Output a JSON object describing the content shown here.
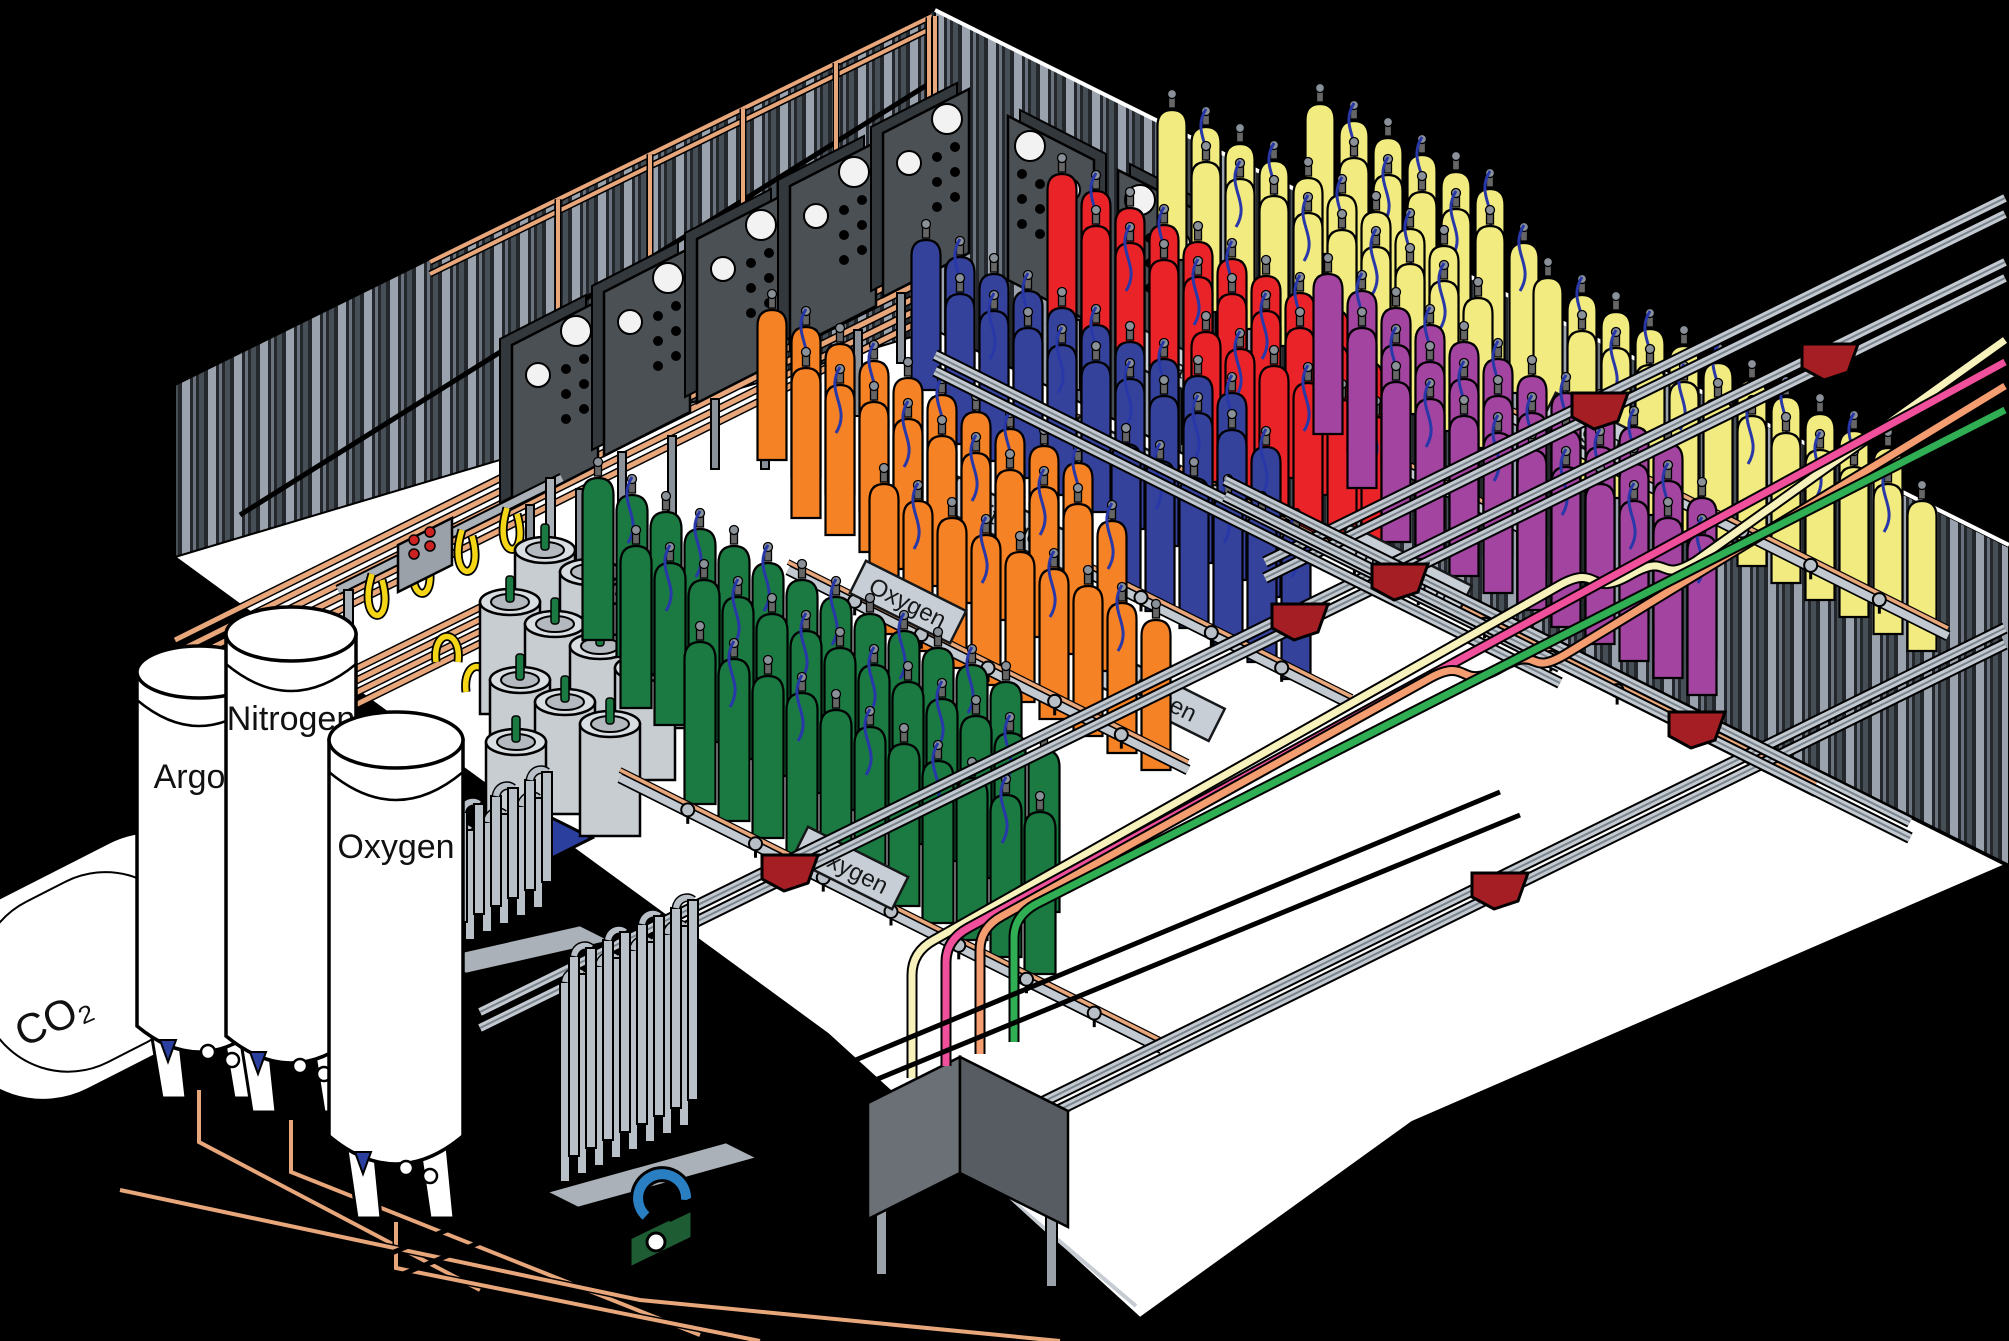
{
  "scene": {
    "subject": "Industrial gas cylinder filling plant (isometric cutaway)",
    "outside_color": "#000000",
    "floor_color": "#ffffff",
    "wall_panel_light": "#9aa3ad",
    "wall_panel_dark": "#24282c",
    "copper_pipe_color": "#e8a67b",
    "rail_color": "#c2c9d1",
    "trolley_color": "#a51e23",
    "sign_plate_color": "#c7ced6",
    "sign_text_color": "#16181a",
    "pigtail_hose_color": "#2838a8",
    "transfer_hose_color": "#f5d616",
    "dewar_color": "#c8cdd2",
    "control_panel_color": "#4b5054",
    "tank_color": "#ffffff"
  },
  "storage_tanks": [
    {
      "id": "co2-tank",
      "label": "CO₂"
    },
    {
      "id": "argon-tank",
      "label": "Argon"
    },
    {
      "id": "nitrogen-tank",
      "label": "Nitrogen"
    },
    {
      "id": "oxygen-tank",
      "label": "Oxygen"
    }
  ],
  "racks": [
    {
      "id": "oxygen-green",
      "label": "Oxygen",
      "cylinder_color": "#1b7a42"
    },
    {
      "id": "oxygen-orange",
      "label": "Oxygen",
      "cylinder_color": "#f58224"
    },
    {
      "id": "nitrogen-blue",
      "label": "Nitrogen",
      "cylinder_color": "#35429b"
    },
    {
      "id": "helium-red",
      "label": "Helium",
      "cylinder_color": "#ea2328"
    },
    {
      "id": "carbon-dioxide-yellow",
      "label": "Carbon Dioxide",
      "cylinder_color": "#f2eb80"
    },
    {
      "id": "argon-yellow",
      "label": "Argon",
      "cylinder_color": "#f2eb80"
    },
    {
      "id": "hydrogen-purple",
      "label": "Hydrogen",
      "cylinder_color": "#a344a1"
    }
  ],
  "supply_lines": [
    {
      "name": "cream-line",
      "color": "#f7f2bb"
    },
    {
      "name": "pink-line",
      "color": "#f0509b"
    },
    {
      "name": "salmon-line",
      "color": "#f49d70"
    },
    {
      "name": "green-line",
      "color": "#2fae53"
    }
  ]
}
